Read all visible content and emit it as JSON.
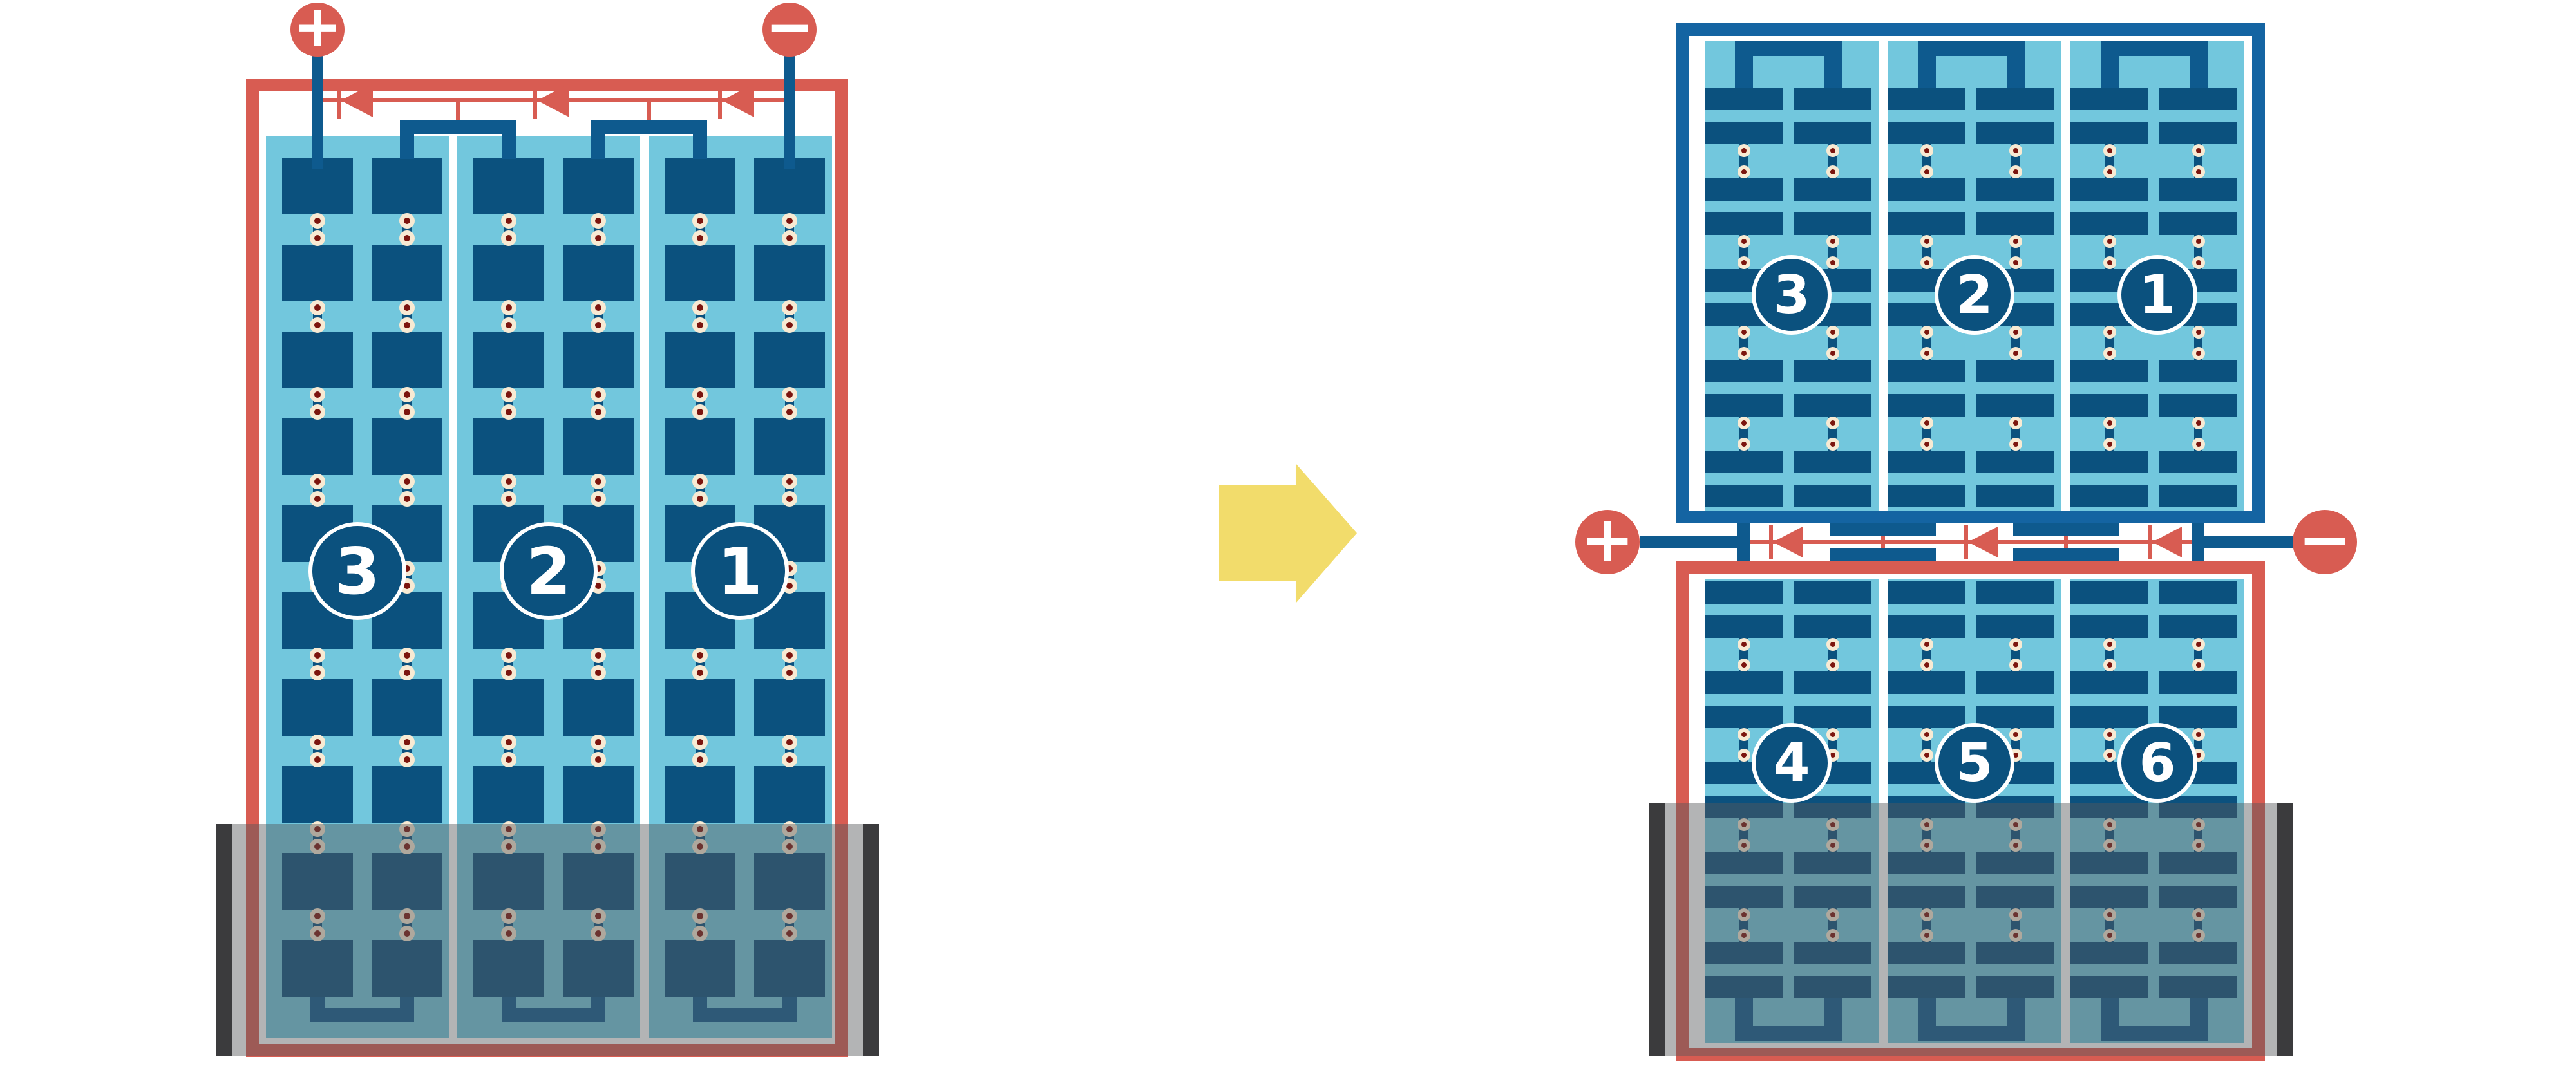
{
  "left_diagram": {
    "type": "full-cell-module",
    "terminals": {
      "positive_label": "+",
      "negative_label": "−"
    },
    "substring_labels": [
      "3",
      "2",
      "1"
    ],
    "substrings": 3,
    "columns_per_substring": 2,
    "cell_rows": 10,
    "bypass_diodes": 3,
    "shaded_area": "bottom"
  },
  "right_diagram": {
    "type": "half-cut-cell-module",
    "terminals": {
      "positive_label": "+",
      "negative_label": "−"
    },
    "top_panel_substring_labels": [
      "3",
      "2",
      "1"
    ],
    "bottom_panel_substring_labels": [
      "4",
      "5",
      "6"
    ],
    "substrings_per_half": 3,
    "columns_per_substring": 2,
    "cell_rows_per_half": 10,
    "bypass_diodes": 3,
    "shaded_area": "bottom"
  },
  "arrow": {
    "icon": "arrow-right",
    "direction": "right"
  },
  "colors": {
    "panel_light_blue": "#72c7dd",
    "cell_dark_blue": "#0b517e",
    "wire_blue": "#0e5a8e",
    "frame_blue": "#1464a2",
    "accent_red": "#d85c52",
    "solder_dot_cream": "#f8ead3",
    "solder_dot_maroon": "#7c150e",
    "arrow_yellow": "#f2dc6b",
    "shading_overlay": "rgba(86,88,92,0.45)",
    "shading_bar_dark": "#3b3b3d",
    "background_white": "#ffffff"
  }
}
